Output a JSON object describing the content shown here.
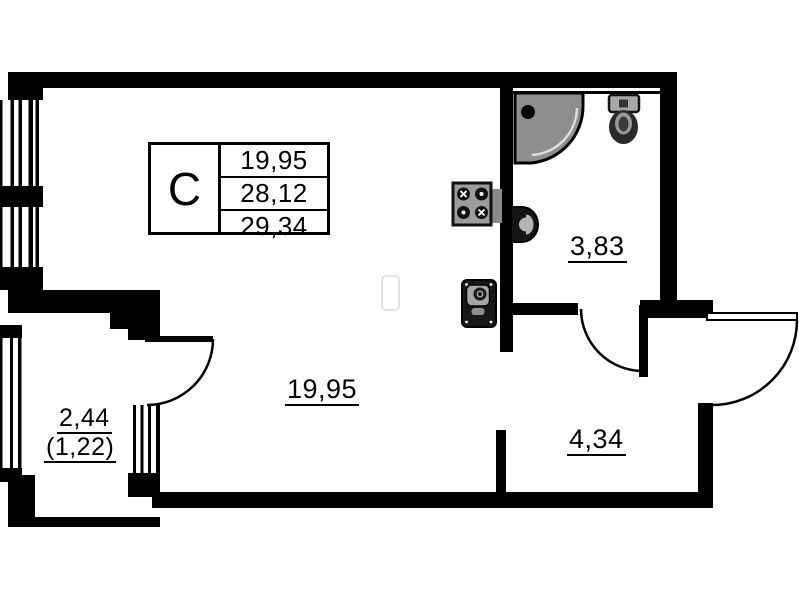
{
  "title": "Studio apartment floor plan",
  "legend": {
    "unit_type": "C",
    "rows": [
      "19,95",
      "28,12",
      "29,34"
    ]
  },
  "rooms": {
    "living": {
      "area": "19,95"
    },
    "bathroom": {
      "area": "3,83"
    },
    "hallway": {
      "area": "4,34"
    },
    "balcony": {
      "area": "2,44",
      "area_reduced": "(1,22)"
    }
  },
  "fixtures": [
    "shower",
    "toilet",
    "washbasin",
    "stove",
    "kitchen-sink"
  ],
  "colors": {
    "background": "#ffffff",
    "wall": "#000000",
    "shower_fill": "#8e8e8e",
    "stove_fill": "#9c9c9c",
    "toilet_tank_fill": "#a8a8a8",
    "kitchen_sink_fill": "#181818",
    "basin_fill": "#151515"
  }
}
